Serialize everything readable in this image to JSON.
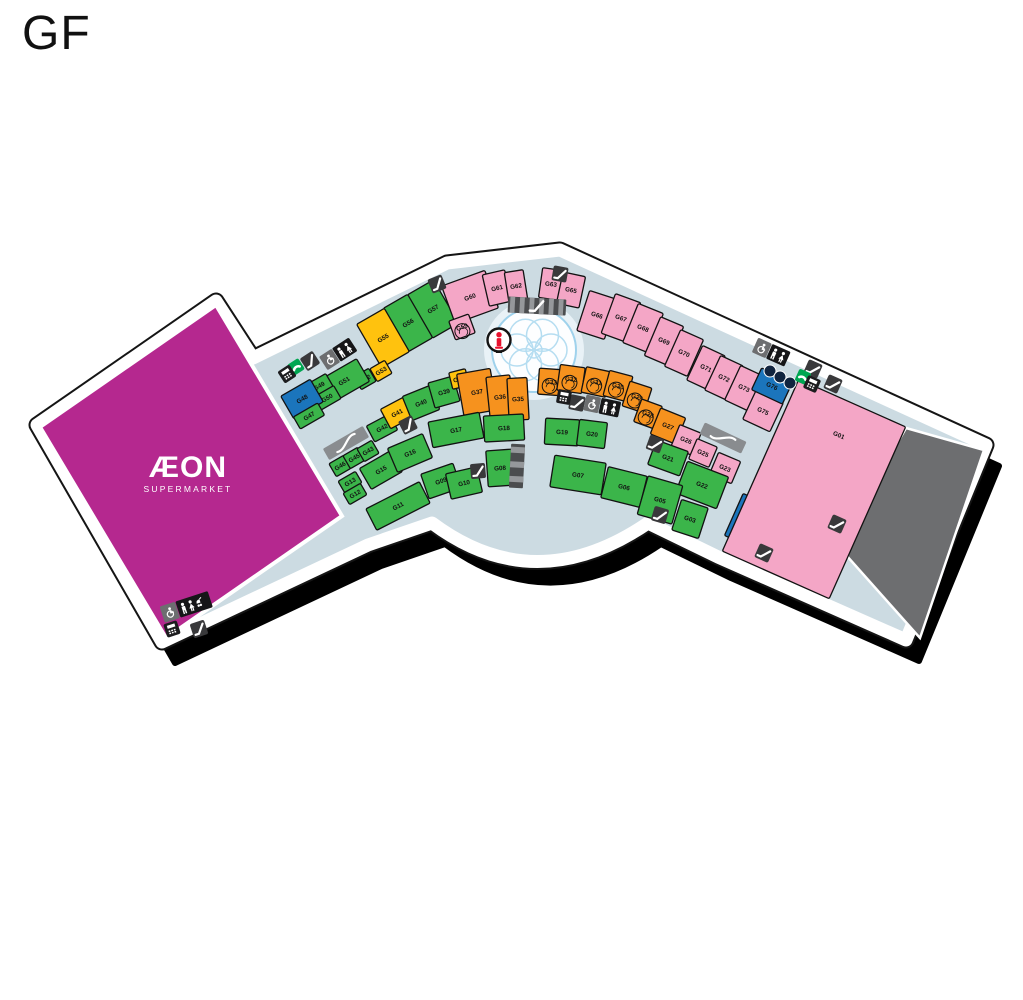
{
  "floor_label": "GF",
  "map": {
    "anchor_label": "ÆON",
    "anchor_sublabel": "SUPERMARKET",
    "palette": {
      "green": "#3bb54a",
      "yellow": "#ffc20e",
      "orange": "#f6921e",
      "pink": "#f4a6c6",
      "blue": "#1b75bc",
      "magenta": "#b5288f",
      "gray": "#6d6e70",
      "floor": "#ccdbe2",
      "outline": "#151515",
      "phone_green": "#00a651",
      "icon_dark": "#39393b",
      "info_red": "#e8112d",
      "fountain_blue": "#9fd2ec"
    },
    "icon_map": {
      "escalator-icon": "dark tile with white diagonal stairs",
      "travelator-icon": "gray bar with white s-curve",
      "phone-icon": "green tile with white handset",
      "atm-icon": "black tile with white keypad",
      "toilets-icon": "wheelchair + man + woman tiles",
      "family-toilets-icon": "wheelchair + man + woman + stroller tiles",
      "information-icon": "round white sign with red i",
      "fountain": "overlapping light blue circles"
    },
    "stores": [
      {
        "label": "G57",
        "type": "green"
      },
      {
        "label": "G56",
        "type": "green"
      },
      {
        "label": "G55",
        "type": "yellow"
      },
      {
        "label": "G53",
        "type": "yellow"
      },
      {
        "label": "G52",
        "type": "green"
      },
      {
        "label": "G51",
        "type": "green"
      },
      {
        "label": "G49",
        "type": "green"
      },
      {
        "label": "G50",
        "type": "green"
      },
      {
        "label": "G48",
        "type": "blue"
      },
      {
        "label": "G47",
        "type": "green"
      },
      {
        "label": "G42",
        "type": "green"
      },
      {
        "label": "G41",
        "type": "yellow"
      },
      {
        "label": "G40",
        "type": "green"
      },
      {
        "label": "G39",
        "type": "green"
      },
      {
        "label": "G38",
        "type": "yellow"
      },
      {
        "label": "G37",
        "type": "orange"
      },
      {
        "label": "G36",
        "type": "orange"
      },
      {
        "label": "G35",
        "type": "orange"
      },
      {
        "label": "G46",
        "type": "green"
      },
      {
        "label": "G45",
        "type": "green"
      },
      {
        "label": "G43",
        "type": "green"
      },
      {
        "label": "G15",
        "type": "green"
      },
      {
        "label": "G13",
        "type": "green"
      },
      {
        "label": "G12",
        "type": "green"
      },
      {
        "label": "G11",
        "type": "green"
      },
      {
        "label": "G16",
        "type": "green"
      },
      {
        "label": "G17",
        "type": "green"
      },
      {
        "label": "G18",
        "type": "green"
      },
      {
        "label": "G09",
        "type": "green"
      },
      {
        "label": "G10",
        "type": "green"
      },
      {
        "label": "G08",
        "type": "green"
      },
      {
        "label": "G19",
        "type": "green"
      },
      {
        "label": "G20",
        "type": "green"
      },
      {
        "label": "G60",
        "type": "pink"
      },
      {
        "label": "G59",
        "type": "pink",
        "badge": true
      },
      {
        "label": "G61",
        "type": "pink"
      },
      {
        "label": "G62",
        "type": "pink"
      },
      {
        "label": "G63",
        "type": "pink"
      },
      {
        "label": "G65",
        "type": "pink"
      },
      {
        "label": "G66",
        "type": "pink"
      },
      {
        "label": "G67",
        "type": "pink"
      },
      {
        "label": "G68",
        "type": "pink"
      },
      {
        "label": "G69",
        "type": "pink"
      },
      {
        "label": "G70",
        "type": "pink"
      },
      {
        "label": "G71",
        "type": "pink"
      },
      {
        "label": "G72",
        "type": "pink"
      },
      {
        "label": "G73",
        "type": "pink"
      },
      {
        "label": "G75",
        "type": "pink"
      },
      {
        "label": "G76",
        "type": "blue"
      },
      {
        "label": "G33",
        "type": "orange",
        "badge": true
      },
      {
        "label": "G32",
        "type": "orange",
        "badge": true
      },
      {
        "label": "G31",
        "type": "orange",
        "badge": true
      },
      {
        "label": "G30",
        "type": "orange",
        "badge": true
      },
      {
        "label": "G29",
        "type": "orange",
        "badge": true
      },
      {
        "label": "G28",
        "type": "orange",
        "badge": true
      },
      {
        "label": "G27",
        "type": "orange"
      },
      {
        "label": "G26",
        "type": "pink"
      },
      {
        "label": "G25",
        "type": "pink"
      },
      {
        "label": "G23",
        "type": "pink"
      },
      {
        "label": "G21",
        "type": "green"
      },
      {
        "label": "G22",
        "type": "green"
      },
      {
        "label": "G07",
        "type": "green"
      },
      {
        "label": "G06",
        "type": "green"
      },
      {
        "label": "G05",
        "type": "green"
      },
      {
        "label": "G03",
        "type": "green"
      },
      {
        "label": "G02",
        "type": "blue"
      },
      {
        "label": "G01",
        "type": "pink"
      }
    ]
  }
}
